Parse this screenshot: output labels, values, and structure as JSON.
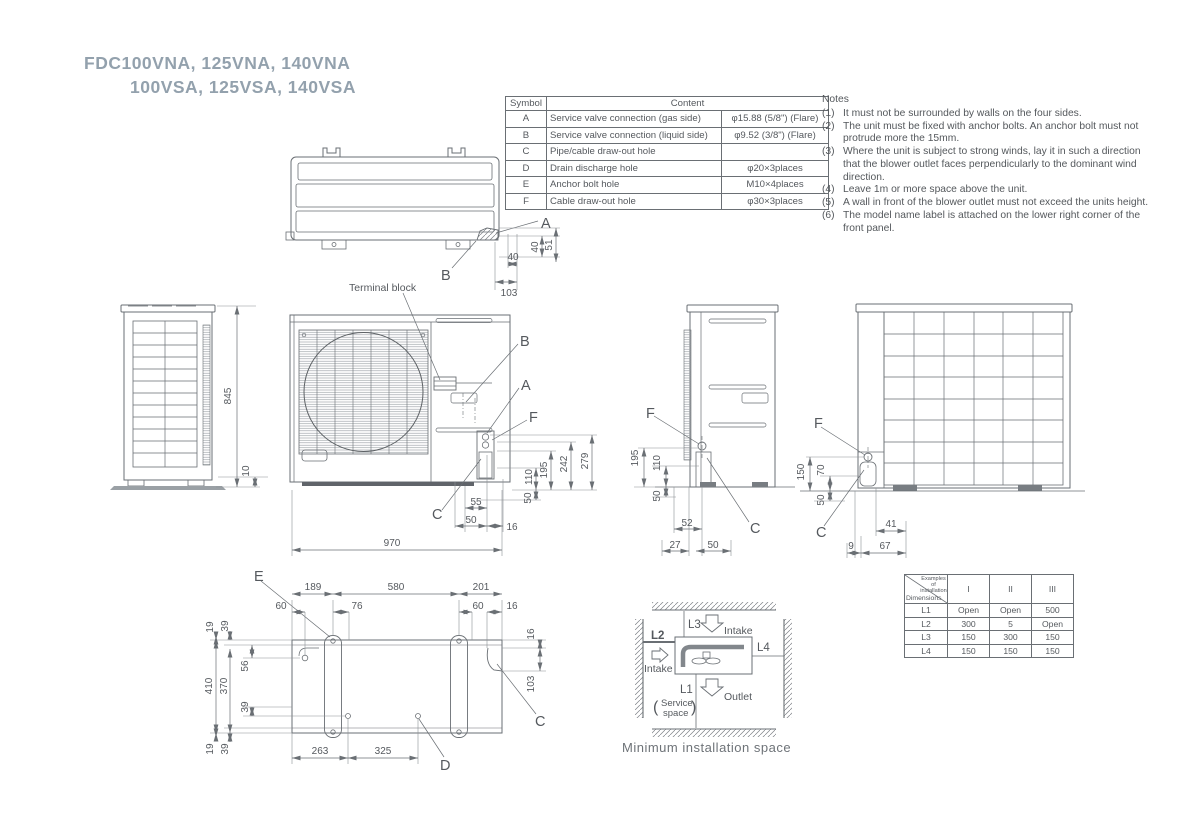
{
  "title": {
    "line1": "FDC100VNA, 125VNA, 140VNA",
    "line2": "100VSA, 125VSA, 140VSA"
  },
  "symbol_table": {
    "header_symbol": "Symbol",
    "header_content": "Content",
    "rows": [
      {
        "symbol": "A",
        "content": "Service valve connection (gas side)",
        "spec": "φ15.88 (5/8\") (Flare)"
      },
      {
        "symbol": "B",
        "content": "Service valve connection (liquid side)",
        "spec": "φ9.52 (3/8\") (Flare)"
      },
      {
        "symbol": "C",
        "content": "Pipe/cable draw-out hole",
        "spec": ""
      },
      {
        "symbol": "D",
        "content": "Drain discharge hole",
        "spec": "φ20×3places"
      },
      {
        "symbol": "E",
        "content": "Anchor bolt hole",
        "spec": "M10×4places"
      },
      {
        "symbol": "F",
        "content": "Cable draw-out hole",
        "spec": "φ30×3places"
      }
    ]
  },
  "notes": {
    "title": "Notes",
    "items": [
      {
        "num": "(1)",
        "text": "It must not be surrounded by walls on the four sides."
      },
      {
        "num": "(2)",
        "text": "The unit must be fixed with anchor bolts. An anchor bolt must not protrude more the 15mm."
      },
      {
        "num": "(3)",
        "text": "Where the unit is subject to strong winds, lay it in such a direction that the blower outlet faces perpendicularly to the dominant wind direction."
      },
      {
        "num": "(4)",
        "text": "Leave 1m or more space above the unit."
      },
      {
        "num": "(5)",
        "text": "A wall in front of the blower outlet must not exceed the units height."
      },
      {
        "num": "(6)",
        "text": "The model name label is attached on the lower right corner of the front panel."
      }
    ]
  },
  "callouts": {
    "a": "A",
    "b": "B",
    "c": "C",
    "d": "D",
    "e": "E",
    "f": "F"
  },
  "labels": {
    "terminal_block": "Terminal block",
    "min_space_caption": "Minimum installation space",
    "intake": "Intake",
    "outlet": "Outlet",
    "service_line1": "Service",
    "service_line2": "space",
    "paren_open": "(",
    "paren_close": ")",
    "l1": "L1",
    "l2": "L2",
    "l3": "L3",
    "l4": "L4"
  },
  "dims": {
    "top": {
      "w40": "40",
      "w103": "103",
      "h40": "40",
      "h51": "51"
    },
    "left_side": {
      "h845": "845",
      "h10": "10"
    },
    "front": {
      "v110": "110",
      "v195": "195",
      "v242": "242",
      "v279": "279",
      "v50": "50",
      "h55": "55",
      "h50": "50",
      "h16": "16",
      "w970": "970"
    },
    "right_side": {
      "v195": "195",
      "v110": "110",
      "v50": "50",
      "b52": "52",
      "b27": "27",
      "b50": "50"
    },
    "back": {
      "v150": "150",
      "v70": "70",
      "v50": "50",
      "b41": "41",
      "b9": "9",
      "b67": "67"
    },
    "bottom": {
      "t189": "189",
      "t580": "580",
      "t201": "201",
      "t60a": "60",
      "t76": "76",
      "t60b": "60",
      "t16": "16",
      "l19a": "19",
      "l39a": "39",
      "l410": "410",
      "l370": "370",
      "l56": "56",
      "l39b": "39",
      "l19b": "19",
      "l39c": "39",
      "r16": "16",
      "r103": "103",
      "b263": "263",
      "b325": "325"
    }
  },
  "install_table": {
    "corner_top": "Examples of installation",
    "corner_bottom": "Dimensions",
    "columns": [
      "I",
      "II",
      "III"
    ],
    "rows": [
      {
        "label": "L1",
        "values": [
          "Open",
          "Open",
          "500"
        ]
      },
      {
        "label": "L2",
        "values": [
          "300",
          "5",
          "Open"
        ]
      },
      {
        "label": "L3",
        "values": [
          "150",
          "300",
          "150"
        ]
      },
      {
        "label": "L4",
        "values": [
          "150",
          "150",
          "150"
        ]
      }
    ]
  }
}
